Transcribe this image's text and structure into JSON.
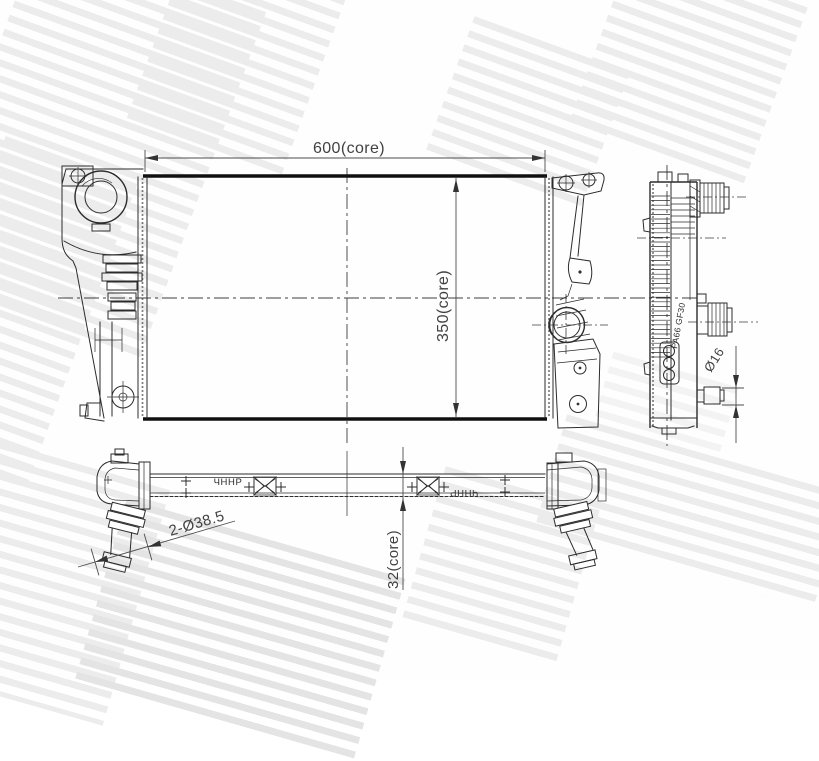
{
  "drawing": {
    "type": "radiator-technical-drawing",
    "dim_core_width": "600(core)",
    "dim_core_height": "350(core)",
    "dim_core_depth": "32(core)",
    "dim_inlet_pipes": "2-Ø38.5",
    "dim_outlet_pipe": "Ø16",
    "material_marking": "PA66 GF30",
    "stamp_left": "ЧННР",
    "stamp_right": "ЧННР"
  },
  "colors": {
    "line": "#2c2c2c",
    "dim_text": "#424242",
    "watermark_stripe": "#ececec",
    "background": "#fefefe"
  }
}
